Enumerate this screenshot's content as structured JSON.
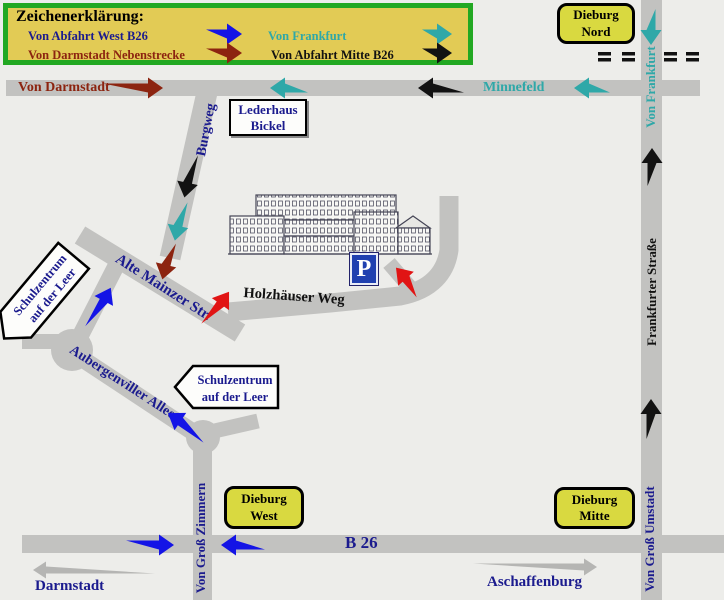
{
  "colors": {
    "background": "#EDEDEA",
    "road": "#C2C2C0",
    "legend_bg": "#E2CB55",
    "legend_border": "#22A822",
    "sign_yellow": "#D9D940",
    "navy": "#1B1B8E",
    "teal": "#2FA8A8",
    "dark_red": "#8C2410",
    "blue": "#1414E6",
    "red": "#E11414",
    "black": "#121212",
    "gray_arrow": "#B5B5B3",
    "parking_blue": "#2040B0"
  },
  "legend": {
    "title": "Zeichenerklärung:",
    "entries": [
      {
        "label": "Von Abfahrt West B26",
        "color": "navy",
        "arrow_color": "blue"
      },
      {
        "label": "Von Frankfurt",
        "color": "teal",
        "arrow_color": "teal"
      },
      {
        "label": "Von Darmstadt Nebenstrecke",
        "color": "dark_red",
        "arrow_color": "dark_red"
      },
      {
        "label": "Von Abfahrt Mitte B26",
        "color": "black",
        "arrow_color": "black"
      }
    ]
  },
  "signs": {
    "dieburg_nord": {
      "line1": "Dieburg",
      "line2": "Nord"
    },
    "dieburg_west": {
      "line1": "Dieburg",
      "line2": "West"
    },
    "dieburg_mitte": {
      "line1": "Dieburg",
      "line2": "Mitte"
    },
    "lederhaus": {
      "line1": "Lederhaus",
      "line2": "Bickel"
    },
    "schulzentrum1": {
      "line1": "Schulzentrum",
      "line2": "auf der Leer"
    },
    "schulzentrum2": {
      "line1": "Schulzentrum",
      "line2": "auf der Leer"
    },
    "parking": "P"
  },
  "road_labels": {
    "von_darmstadt": "Von Darmstadt",
    "minnefeld": "Minnefeld",
    "von_frankfurt": "Von Frankfurt",
    "burgweg": "Burgweg",
    "alte_mainzer": "Alte Mainzer Str.",
    "holzhaeuser": "Holzhäuser Weg",
    "aubergenviller": "Aubergenviller Allee",
    "frankfurter": "Frankfurter Straße",
    "von_gross_zimmern": "Von Groß Zimmern",
    "von_gross_umstadt": "Von Groß Umstadt",
    "b26": "B 26",
    "darmstadt": "Darmstadt",
    "aschaffenburg": "Aschaffenburg"
  },
  "arrows": [
    {
      "route": "legend-von-abfahrt-west",
      "color": "blue",
      "x": 224,
      "y": 34,
      "angle": 0,
      "len": 36
    },
    {
      "route": "legend-von-frankfurt",
      "color": "teal",
      "x": 437,
      "y": 34,
      "angle": 0,
      "len": 30
    },
    {
      "route": "legend-von-darmstadt-nebenstrecke",
      "color": "dark_red",
      "x": 224,
      "y": 53,
      "angle": 0,
      "len": 36
    },
    {
      "route": "legend-von-abfahrt-mitte",
      "color": "black",
      "x": 437,
      "y": 53,
      "angle": 0,
      "len": 30
    },
    {
      "route": "von-darmstadt-nebenstrecke",
      "color": "dark_red",
      "x": 133,
      "y": 88,
      "angle": 0,
      "len": 60
    },
    {
      "route": "von-frankfurt",
      "color": "teal",
      "x": 289,
      "y": 88,
      "angle": 180,
      "len": 38
    },
    {
      "route": "von-abfahrt-mitte-b26",
      "color": "black",
      "x": 441,
      "y": 88,
      "angle": 180,
      "len": 46
    },
    {
      "route": "von-frankfurt",
      "color": "teal",
      "x": 592,
      "y": 88,
      "angle": 180,
      "len": 36
    },
    {
      "route": "von-frankfurt",
      "color": "teal",
      "x": 651,
      "y": 27,
      "angle": 90,
      "len": 36
    },
    {
      "route": "von-abfahrt-mitte-b26",
      "color": "black",
      "x": 652,
      "y": 167,
      "angle": -90,
      "len": 38
    },
    {
      "route": "von-abfahrt-mitte-b26",
      "color": "black",
      "x": 651,
      "y": 419,
      "angle": -90,
      "len": 40
    },
    {
      "route": "von-abfahrt-mitte-b26",
      "color": "black",
      "x": 189,
      "y": 176,
      "angle": 102,
      "len": 44
    },
    {
      "route": "von-frankfurt",
      "color": "teal",
      "x": 179,
      "y": 221,
      "angle": 102,
      "len": 40
    },
    {
      "route": "von-darmstadt-nebenstrecke",
      "color": "dark_red",
      "x": 167,
      "y": 261,
      "angle": 104,
      "len": 38
    },
    {
      "route": "von-abfahrt-west-b26",
      "color": "blue",
      "x": 100,
      "y": 308,
      "angle": -62,
      "len": 46
    },
    {
      "route": "final-approach",
      "color": "red",
      "x": 217,
      "y": 309,
      "angle": -55,
      "len": 42
    },
    {
      "route": "final-approach-parking",
      "color": "red",
      "x": 408,
      "y": 281,
      "angle": -132,
      "len": 36
    },
    {
      "route": "von-abfahrt-west-b26",
      "color": "blue",
      "x": 187,
      "y": 426,
      "angle": -146,
      "len": 46
    },
    {
      "route": "b26-eastbound",
      "color": "blue",
      "x": 150,
      "y": 545,
      "angle": 0,
      "len": 48
    },
    {
      "route": "b26-westbound",
      "color": "blue",
      "x": 243,
      "y": 545,
      "angle": 180,
      "len": 44
    },
    {
      "route": "to-darmstadt",
      "color": "gray_arrow",
      "x": 94,
      "y": 570,
      "angle": 180,
      "len": 122,
      "style": "thin"
    },
    {
      "route": "to-aschaffenburg",
      "color": "gray_arrow",
      "x": 535,
      "y": 567,
      "angle": 0,
      "len": 124,
      "style": "thin"
    }
  ]
}
